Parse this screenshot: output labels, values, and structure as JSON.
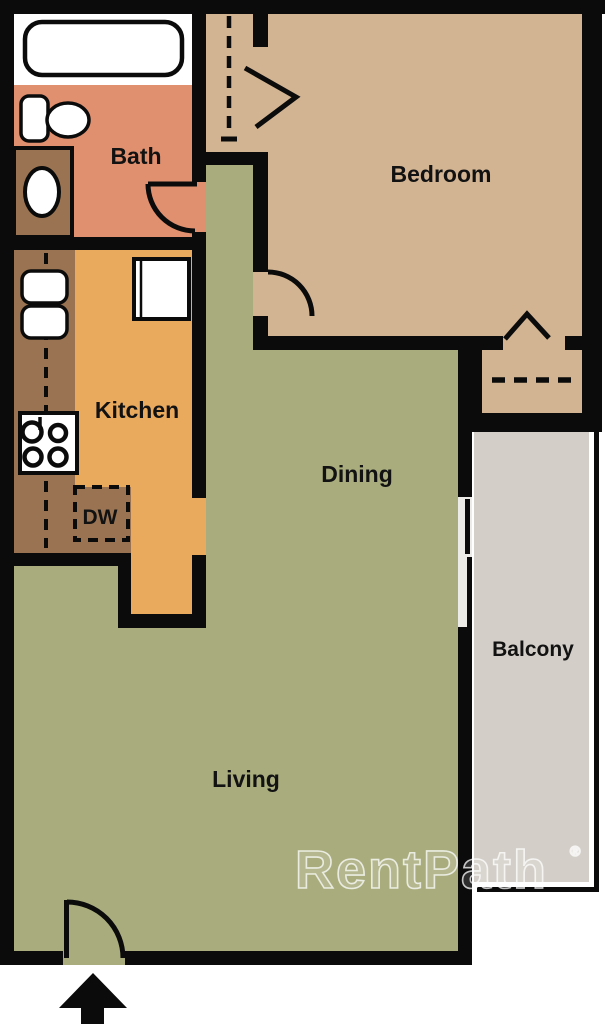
{
  "floorplan": {
    "rooms": {
      "bath": "Bath",
      "bedroom": "Bedroom",
      "kitchen": "Kitchen",
      "dishwasher": "DW",
      "dining": "Dining",
      "living": "Living",
      "balcony": "Balcony"
    },
    "watermark": {
      "text": "RentPath",
      "registered": "®"
    },
    "colors": {
      "wall": "#0b0b0b",
      "bath": "#e0906f",
      "bedroom": "#d2b492",
      "kitchen": "#e9aa5e",
      "counter": "#9a7452",
      "living": "#a9ad7d",
      "balcony": "#d3cfc8",
      "fixture": "#ffffff",
      "slider_track": "#edebe7",
      "label": "#121212",
      "watermark": "#ffffff"
    }
  }
}
